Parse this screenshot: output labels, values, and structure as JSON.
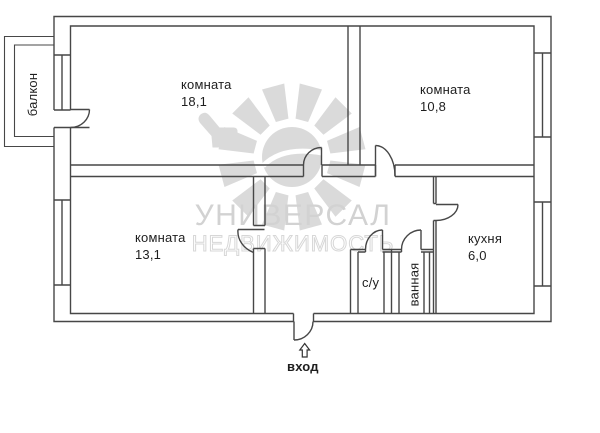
{
  "plan": {
    "rooms": {
      "room1": {
        "name": "комната",
        "area": "18,1"
      },
      "room2": {
        "name": "комната",
        "area": "10,8"
      },
      "room3": {
        "name": "комната",
        "area": "13,1"
      },
      "kitchen": {
        "name": "кухня",
        "area": "6,0"
      },
      "toilet": {
        "name": "с/у"
      },
      "bathroom": {
        "name": "ванная"
      },
      "balcony": {
        "name": "балкон"
      }
    },
    "entrance": {
      "label": "вход",
      "arrow_icon": "up-outline-arrow"
    },
    "watermark": {
      "line1": "УНИВЕРСАЛ",
      "line2": "НЕДВИЖИМОСТЬ"
    },
    "colors": {
      "wall": "#474747",
      "label_text": "#1e1e1e",
      "watermark": "#d2d2d2",
      "background": "#ffffff"
    }
  }
}
